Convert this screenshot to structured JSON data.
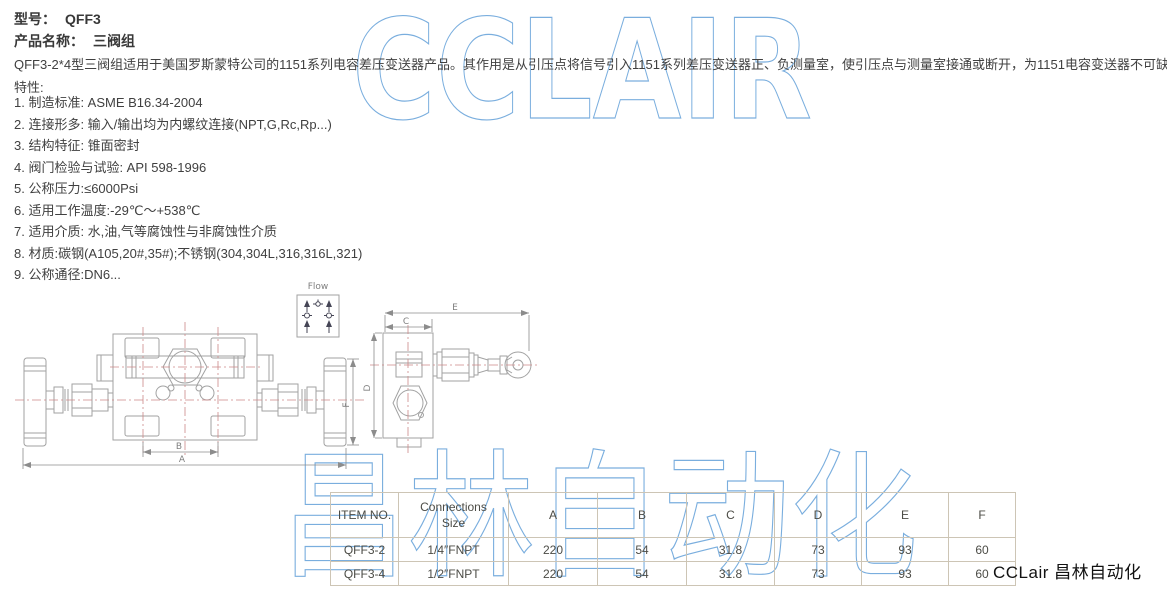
{
  "header": {
    "model_label": "型号：",
    "model_value": "QFF3",
    "product_label": "产品名称：",
    "product_value": "三阀组"
  },
  "description": "QFF3-2*4型三阀组适用于美国罗斯蒙特公司的1151系列电容差压变送器产品。其作用是从引压点将信号引入1151系列差压变送器正、负测量室，使引压点与测量室接通或断开，为1151电容变送器不可缺少的配件。",
  "features_title": "特性:",
  "features": [
    "1. 制造标准: ASME B16.34-2004",
    "2. 连接形多: 输入/输出均为内螺纹连接(NPT,G,Rc,Rp...)",
    "3. 结构特征: 锥面密封",
    "4. 阀门检验与试验: API 598-1996",
    "5. 公称压力:≤6000Psi",
    "6. 适用工作温度:-29℃～+538℃",
    "7. 适用介质: 水,油,气等腐蚀性与非腐蚀性介质",
    "8. 材质:碳钢(A105,20#,35#);不锈钢(304,304L,316,316L,321)",
    "9. 公称通径:DN6..."
  ],
  "drawing": {
    "labels": {
      "flow": "Flow",
      "a": "A",
      "b": "B",
      "c": "C",
      "d": "D",
      "e": "E",
      "f": "F"
    }
  },
  "table": {
    "headers": [
      "ITEM NO.",
      "Connections\nSize",
      "A",
      "B",
      "C",
      "D",
      "E",
      "F"
    ],
    "rows": [
      [
        "QFF3-2",
        "1/4″FNPT",
        "220",
        "54",
        "31.8",
        "73",
        "93",
        "60"
      ],
      [
        "QFF3-4",
        "1/2″FNPT",
        "220",
        "54",
        "31.8",
        "73",
        "93",
        "60"
      ]
    ]
  },
  "watermark": {
    "latin": "CCLAIR",
    "chinese": "昌林自动化",
    "color": "#7AAEDE"
  },
  "footer_logo": "CCLair 昌林自动化"
}
